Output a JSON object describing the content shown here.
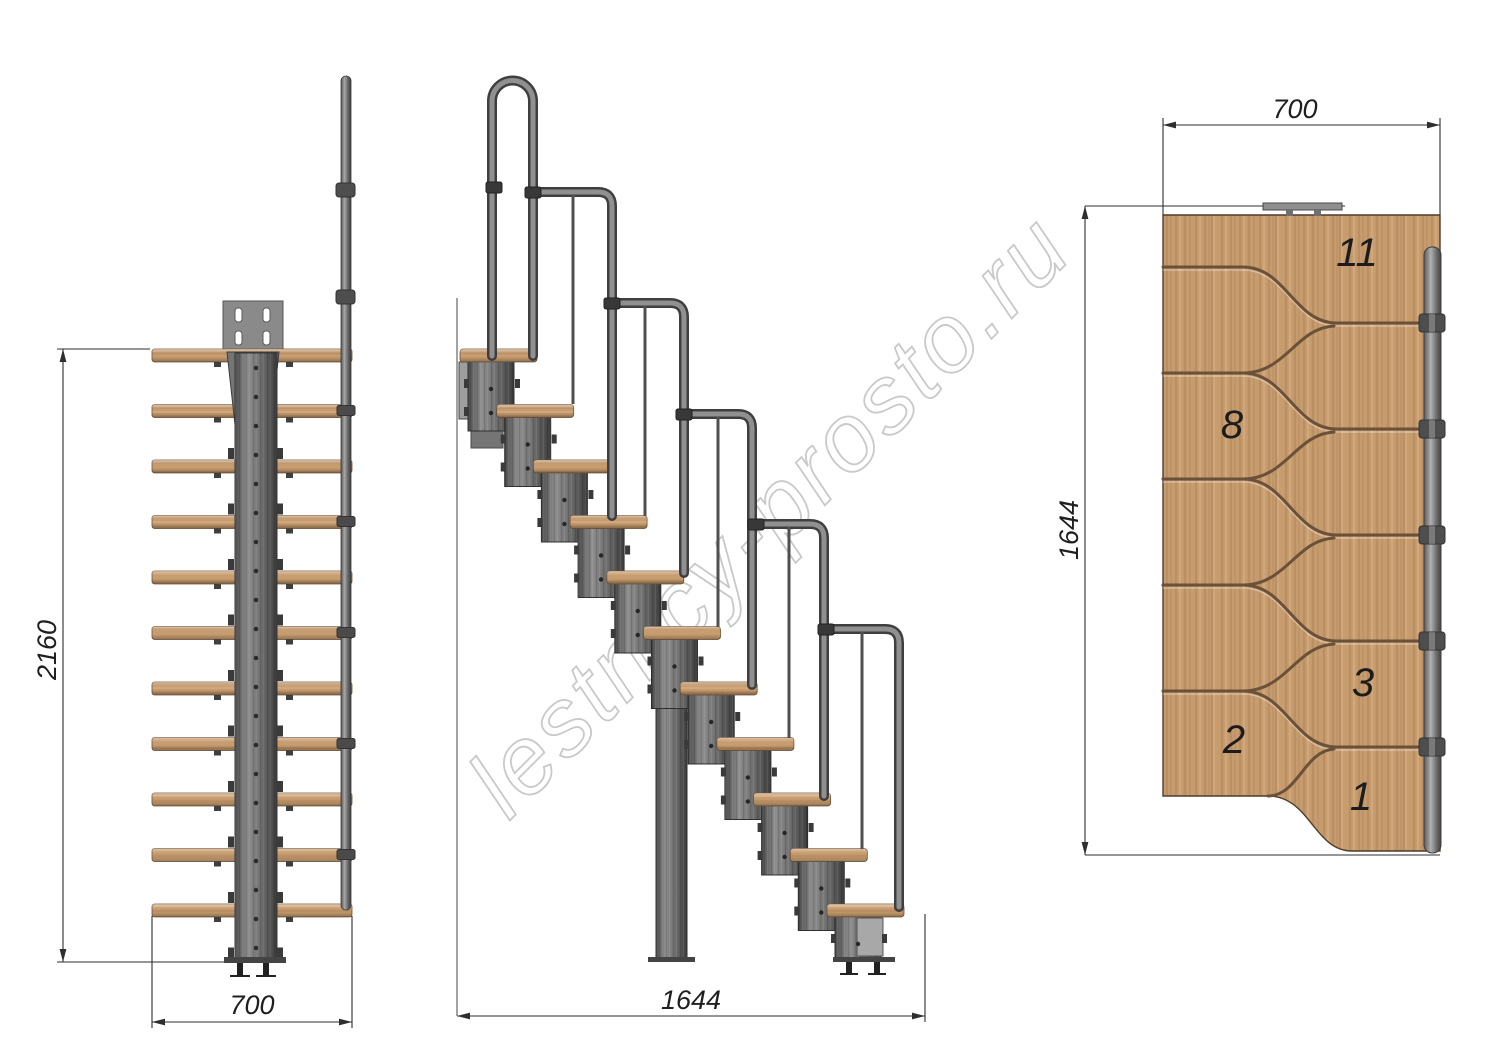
{
  "watermark": {
    "text": "lestnicy-prosto.ru",
    "outline_color": "#c9c9c9"
  },
  "dims": {
    "front_height": "2160",
    "front_width": "700",
    "side_run": "1644",
    "plan_width": "700",
    "plan_depth": "1644"
  },
  "plan": {
    "tread_numbers": [
      "11",
      "8",
      "3",
      "2",
      "1"
    ]
  },
  "colors": {
    "wood": "#c79c6f",
    "wood_groove": "#6b5138",
    "steel": "#7a7a7a",
    "dimension_line": "#2e2e2e"
  }
}
